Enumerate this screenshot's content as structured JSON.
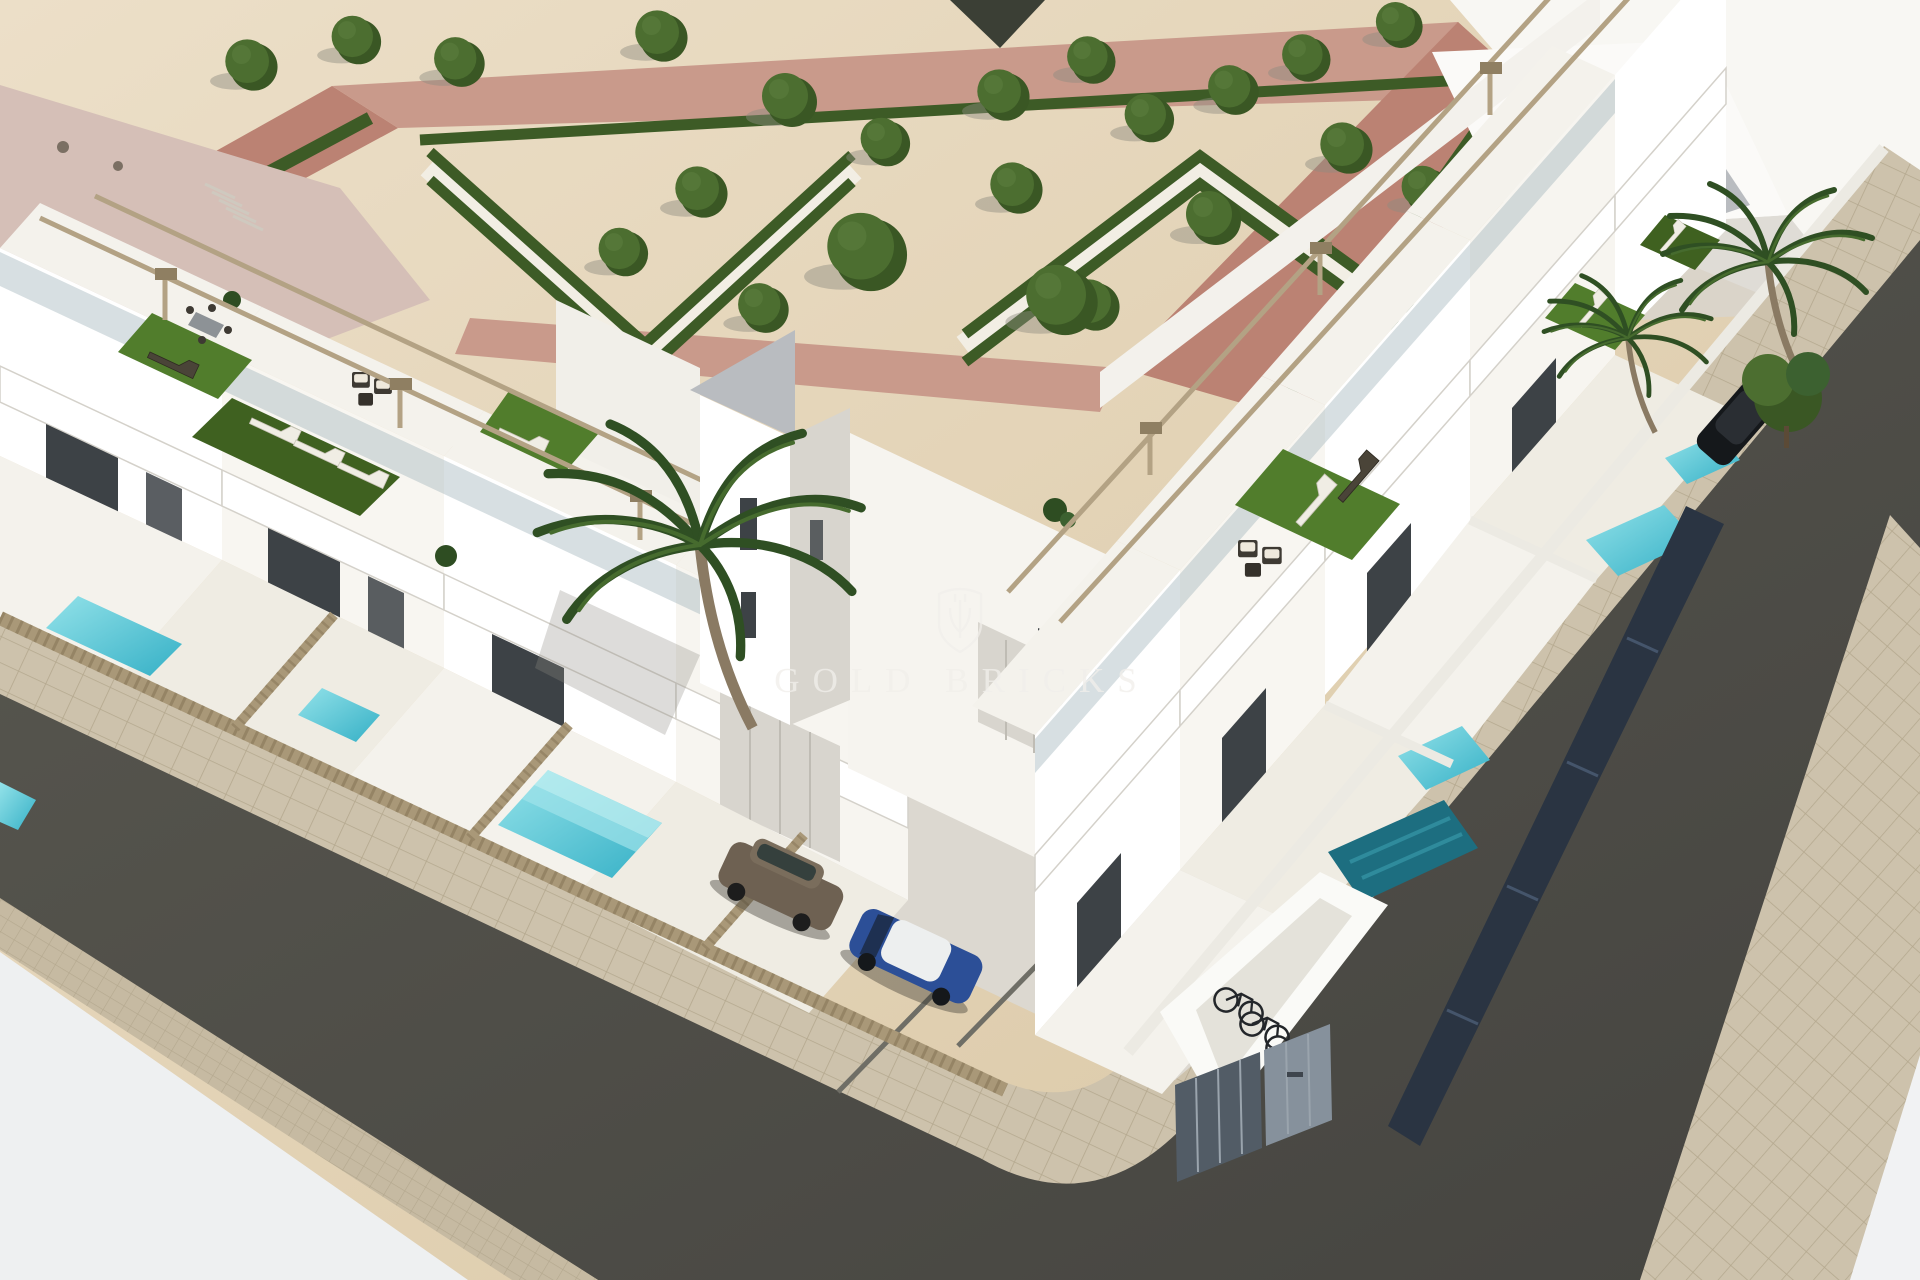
{
  "watermark": {
    "text": "GOLD BRICKS",
    "logo_icon": "shield-trident-icon"
  },
  "palette": {
    "sand": "#e2d3b4",
    "sandA": "#ecdfc8",
    "sandB": "#d9c6a3",
    "white": "#ffffff",
    "offwhite": "#f4f2ec",
    "brightpave": "#f8f7f3",
    "roofPink": "#d5bfb7",
    "pathPink": "#bb8273",
    "pathPinkLight": "#c99a8b",
    "hedge": "#3d5b26",
    "parkPath": "#f2eee4",
    "tree": "#4c6e30",
    "treeDark": "#3a5724",
    "wallShade": "#d8d5ce",
    "wallGray": "#b9bcc0",
    "winDark": "#3d4246",
    "turf": "#517d2c",
    "turfDark": "#3f6120",
    "wood": "#b3a284",
    "woodDark": "#8f7f62",
    "fence": "#a99878",
    "fenceDark": "#857455",
    "poolA": "#93e2e9",
    "poolB": "#35b0c6",
    "poolTeal": "#1d6e80",
    "roadA": "#595850",
    "roadB": "#454440",
    "sidewalk": "#cdc2ac",
    "sidewalkLine": "#b4a88e",
    "curb": "#c6baa2",
    "concrete": "#dcd8d0",
    "concreteLine": "#6f6e66",
    "carBrown": "#6e6152",
    "carBlue": "#2c4f97",
    "carDark": "#15181b",
    "bike": "#23262a",
    "cabinet": "#86919c",
    "cabinetDark": "#525c66",
    "navyPanel": "#2a3442",
    "palm": "#2f4f23",
    "palmLight": "#466b2e",
    "shadow": "#8e8b80",
    "glass": "#9fb2bb",
    "watermark": "#f1efeb"
  }
}
